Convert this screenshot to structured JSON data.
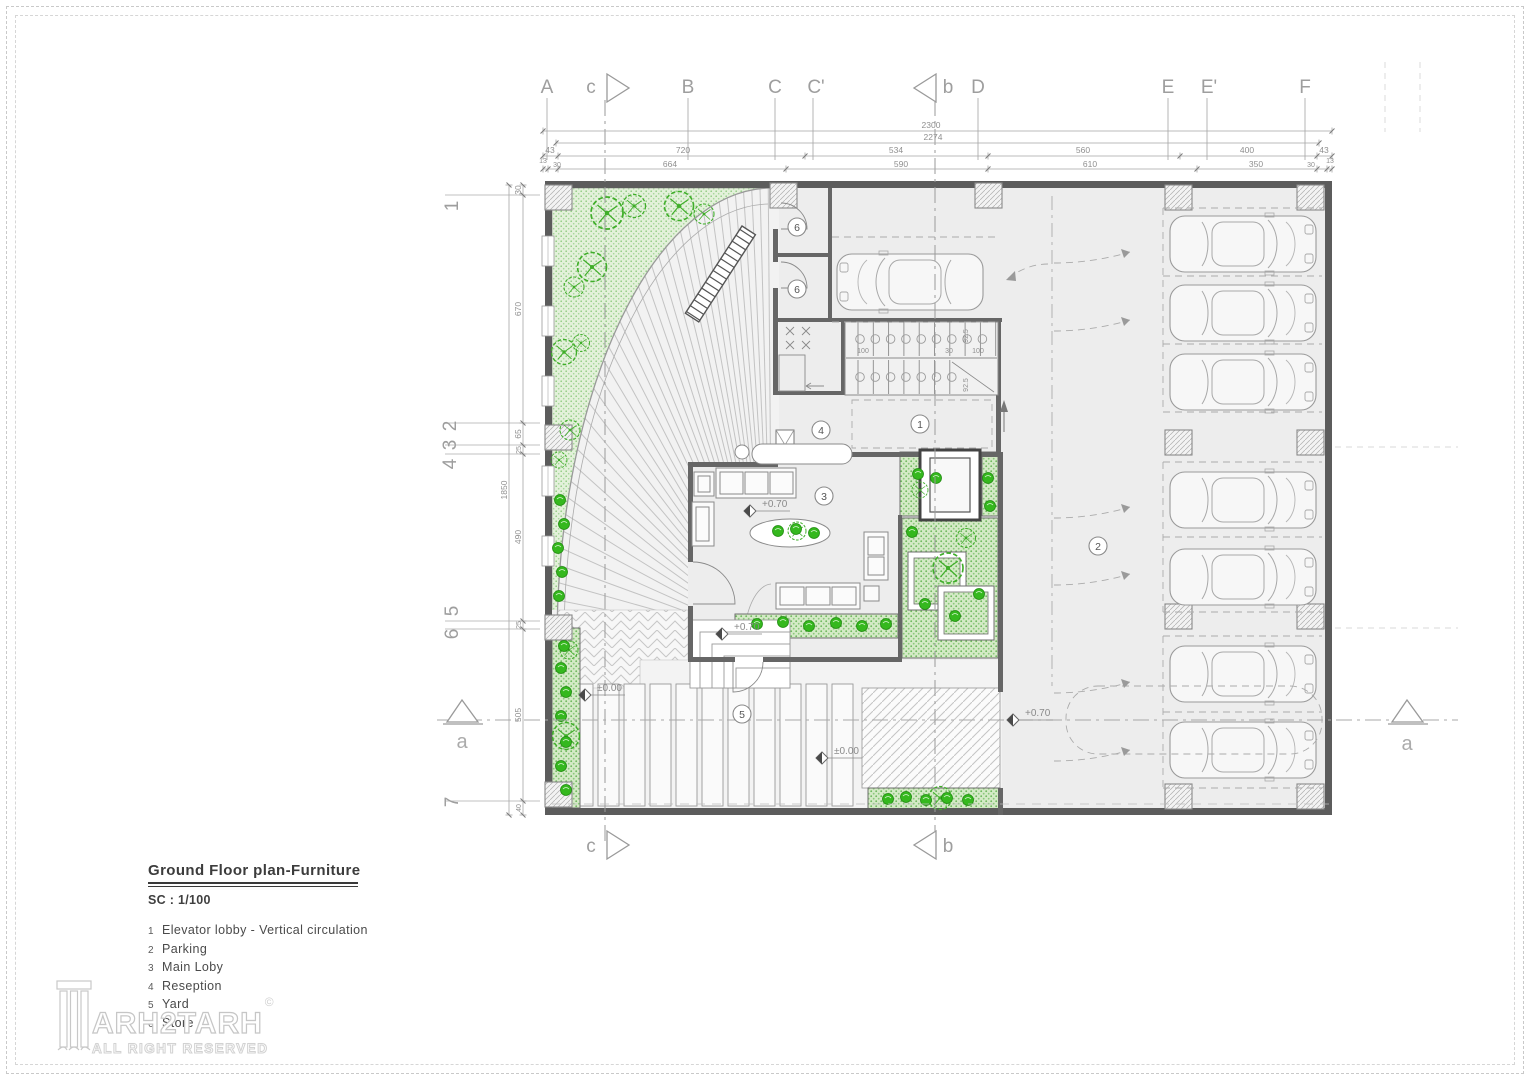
{
  "title_block": {
    "title": "Ground Floor plan-Furniture",
    "scale": "SC : 1/100",
    "legend": [
      {
        "n": "1",
        "label": "Elevator lobby - Vertical circulation"
      },
      {
        "n": "2",
        "label": "Parking"
      },
      {
        "n": "3",
        "label": "Main Loby"
      },
      {
        "n": "4",
        "label": "Reseption"
      },
      {
        "n": "5",
        "label": "Yard"
      },
      {
        "n": "6",
        "label": "Store"
      }
    ]
  },
  "logo": {
    "brand": "ARH2TARH",
    "mark": "©",
    "tagline": "ALL RIGHT RESERVED"
  },
  "grid": {
    "top": [
      "A",
      "c",
      "B",
      "C",
      "C'",
      "b",
      "D",
      "E",
      "E'",
      "F"
    ],
    "left": [
      "1",
      "2",
      "3",
      "4",
      "5",
      "6",
      "7"
    ],
    "bottom": [
      "c",
      "b"
    ],
    "section": "a"
  },
  "dims": {
    "top_total": "2300",
    "top_inner": "2274",
    "top_row3": [
      "43",
      "720",
      "534",
      "560",
      "400",
      "43"
    ],
    "top_row4": [
      "13",
      "30",
      "664",
      "590",
      "610",
      "350",
      "30",
      "13"
    ],
    "left_total": "1850",
    "left_segs": [
      "30",
      "670",
      "65",
      "25",
      "490",
      "25",
      "505",
      "40"
    ],
    "stair": [
      "100",
      "30",
      "100",
      "92.5",
      "92.5"
    ]
  },
  "levels": {
    "main_lobby": "+0.70",
    "terrace": "+0.70",
    "parking": "+0.70",
    "yard_a": "±0.00",
    "yard_b": "±0.00"
  },
  "tags": {
    "elevator_lobby": "1",
    "parking": "2",
    "main_lobby": "3",
    "reception": "4",
    "yard": "5",
    "store": "6"
  },
  "colors": {
    "vegetation": "#3fae29",
    "planting_fill": "#d8ecc9",
    "garden_fill": "#e3f1da",
    "wall": "#5c5c5c",
    "floor": "#ededed",
    "line": "#9a9a9a"
  }
}
